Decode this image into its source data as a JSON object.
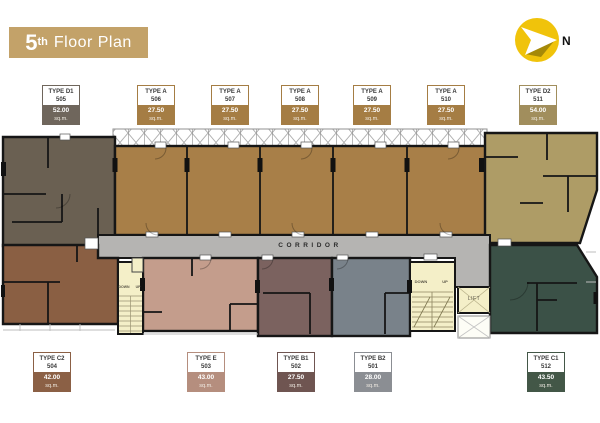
{
  "title": {
    "floor_number": "5",
    "ordinal_suffix": "th",
    "text": "Floor Plan"
  },
  "compass": {
    "label": "N"
  },
  "colors": {
    "banner_bg": "#c3a269",
    "banner_text": "#ffffff",
    "compass_yellow": "#f0c30b"
  },
  "unit_labels": {
    "top": [
      {
        "type": "TYPE D1",
        "unit_no": "505",
        "area": "52.00",
        "sqm": "sq.m.",
        "color": "#6f665c"
      },
      {
        "type": "TYPE A",
        "unit_no": "506",
        "area": "27.50",
        "sqm": "sq.m.",
        "color": "#a57d44"
      },
      {
        "type": "TYPE A",
        "unit_no": "507",
        "area": "27.50",
        "sqm": "sq.m.",
        "color": "#a57d44"
      },
      {
        "type": "TYPE A",
        "unit_no": "508",
        "area": "27.50",
        "sqm": "sq.m.",
        "color": "#a57d44"
      },
      {
        "type": "TYPE A",
        "unit_no": "509",
        "area": "27.50",
        "sqm": "sq.m.",
        "color": "#a57d44"
      },
      {
        "type": "TYPE A",
        "unit_no": "510",
        "area": "27.50",
        "sqm": "sq.m.",
        "color": "#a57d44"
      },
      {
        "type": "TYPE D2",
        "unit_no": "511",
        "area": "54.00",
        "sqm": "sq.m.",
        "color": "#a18e5d"
      }
    ],
    "bottom": [
      {
        "type": "TYPE C2",
        "unit_no": "504",
        "area": "42.00",
        "sqm": "sq.m.",
        "color": "#8b6045"
      },
      {
        "type": "TYPE E",
        "unit_no": "503",
        "area": "43.00",
        "sqm": "sq.m.",
        "color": "#b58e7e"
      },
      {
        "type": "TYPE B1",
        "unit_no": "502",
        "area": "27.50",
        "sqm": "sq.m.",
        "color": "#6f5551"
      },
      {
        "type": "TYPE B2",
        "unit_no": "501",
        "area": "28.00",
        "sqm": "sq.m.",
        "color": "#8b8e93"
      },
      {
        "type": "TYPE C1",
        "unit_no": "512",
        "area": "43.50",
        "sqm": "sq.m.",
        "color": "#435747"
      }
    ]
  },
  "plan": {
    "corridor_label": "CORRIDOR",
    "lift_label": "LIFT",
    "stairs_left": {
      "down_label": "DOWN",
      "up_label": "UP"
    },
    "stairs_right": {
      "down_label": "DOWN",
      "up_label": "UP"
    },
    "fills": {
      "unit_505": "#6a6052",
      "units_506_510": "#a87f48",
      "unit_511": "#ae9c66",
      "corridor": "#b5b4b2",
      "unit_504": "#8a5f43",
      "unit_503": "#c49d8c",
      "unit_502": "#7b625f",
      "unit_501": "#79828a",
      "unit_512": "#3b5147",
      "stairs": "#f4efc8"
    }
  }
}
